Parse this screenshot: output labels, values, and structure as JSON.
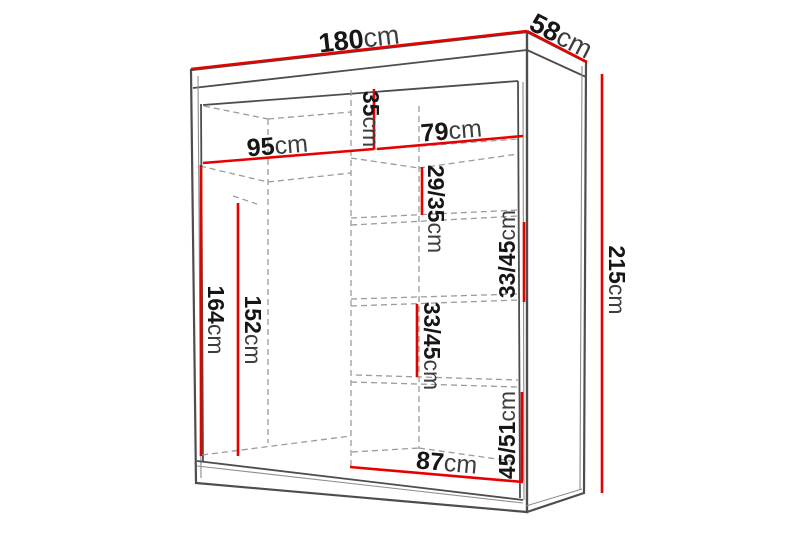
{
  "diagram": {
    "subject": "wardrobe-dimension-drawing",
    "background": "#ffffff"
  },
  "colors": {
    "measure_line": "#e60000",
    "outline": "#4d4d4d",
    "hidden_edge": "#9b9b9b",
    "number_text": "#161616",
    "unit_text": "#3d3d3d"
  },
  "measurements": {
    "width": {
      "value": "180",
      "unit": "cm"
    },
    "depth": {
      "value": "58",
      "unit": "cm"
    },
    "height": {
      "value": "215",
      "unit": "cm"
    },
    "left_section_width": {
      "value": "95",
      "unit": "cm"
    },
    "top_shelf_height": {
      "value": "35",
      "unit": "cm"
    },
    "right_section_width": {
      "value": "79",
      "unit": "cm"
    },
    "shelf_gap_upper": {
      "value": "29/35",
      "unit": "cm"
    },
    "shelf_gap_mid_right": {
      "value": "33/45",
      "unit": "cm"
    },
    "shelf_gap_mid_left": {
      "value": "33/45",
      "unit": "cm"
    },
    "shelf_gap_bottom": {
      "value": "45/51",
      "unit": "cm"
    },
    "left_interior_height": {
      "value": "164",
      "unit": "cm"
    },
    "hanging_height": {
      "value": "152",
      "unit": "cm"
    },
    "bottom_section_width": {
      "value": "87",
      "unit": "cm"
    }
  }
}
